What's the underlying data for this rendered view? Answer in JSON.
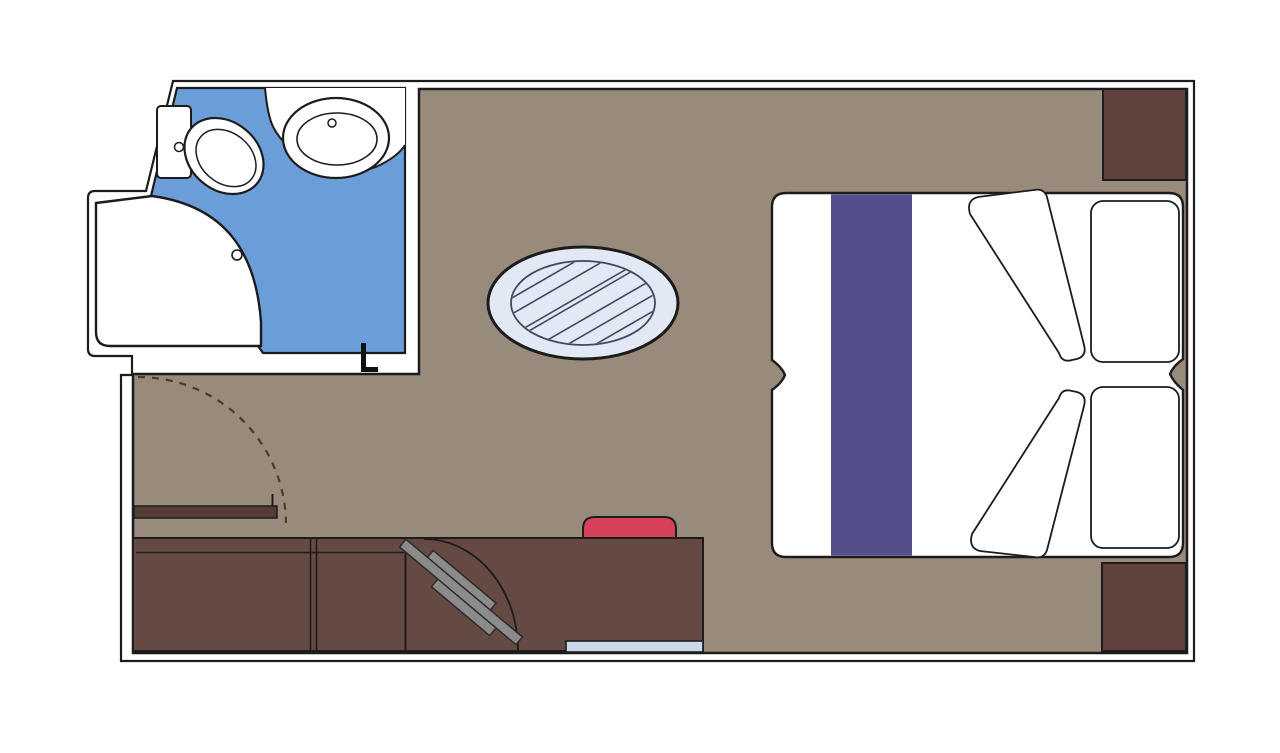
{
  "plan": {
    "type": "cabin-floor-plan",
    "rooms": [
      "main-cabin",
      "bathroom",
      "shower",
      "entrance-corridor"
    ],
    "furniture": [
      "double-bed",
      "bed-runner",
      "pillow-upper",
      "pillow-lower",
      "folded-duvet-upper",
      "folded-duvet-lower",
      "round-table",
      "desk-cabinet",
      "tv-bracket",
      "stool",
      "glass-strip",
      "wall-shelf",
      "wardrobe-top-right",
      "wardrobe-bottom-right",
      "toilet",
      "washbasin",
      "vanity-counter",
      "shower-tray",
      "entrance-door-swing",
      "bathroom-door-hinge"
    ]
  },
  "colors": {
    "line": "#1c1c1c",
    "frame_fill": "#ffffff",
    "floor": "#988b7c",
    "bath_floor": "#6b9dd8",
    "fixture": "#ffffff",
    "table_rim": "#e3e9f4",
    "table_lines": "#3f4a5e",
    "bed": "#ffffff",
    "runner": "#544f8b",
    "pillow": "#ffffff",
    "wardrobe": "#5e423b",
    "desk": "#644a43",
    "shelf": "#533c36",
    "stool": "#d8415a",
    "tv": "#8b8b8b",
    "tv_line": "#2c2c2c",
    "glass": "#ccd7ea",
    "door_arc": "#4a3b31",
    "hinge": "#111111"
  }
}
